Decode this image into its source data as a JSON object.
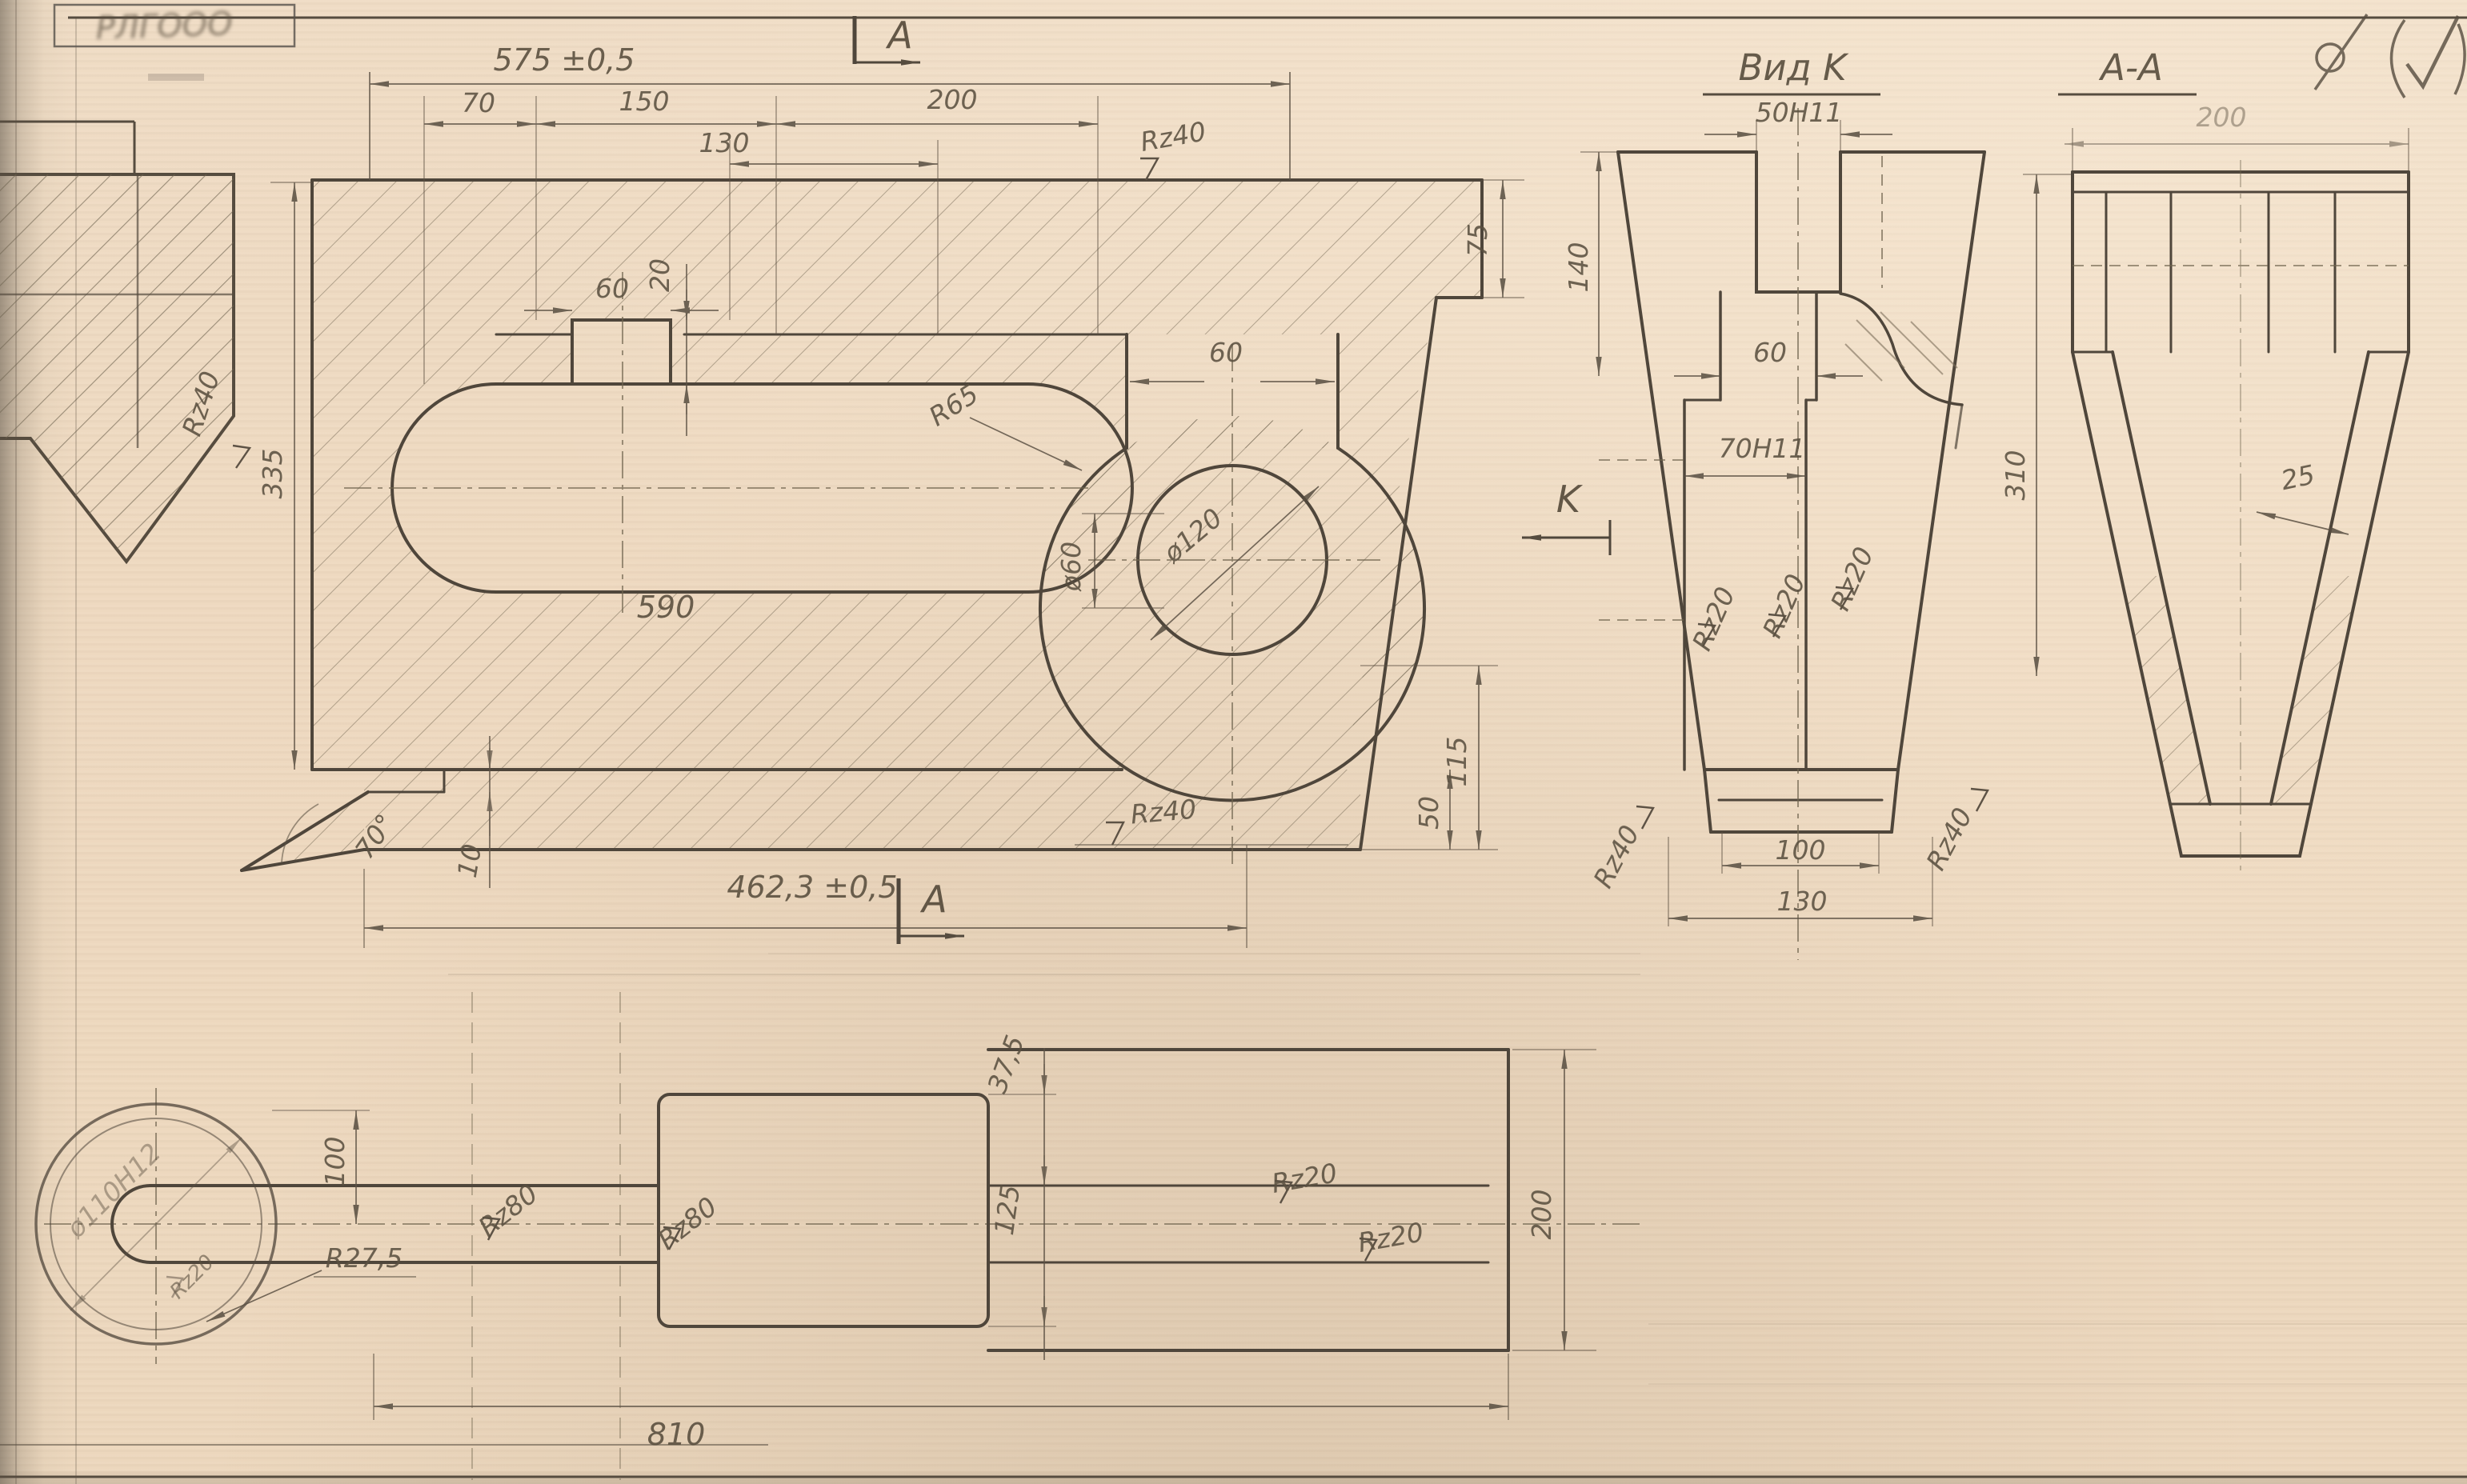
{
  "page": {
    "background": "#eed9c0",
    "ink": "#584e41"
  },
  "stamp": {
    "text": "РЛГООО"
  },
  "corner_icons": {
    "general_roughness": "circle-slash",
    "approval_check": "(✓)"
  },
  "main_view": {
    "section_label_top": "A",
    "section_label_bottom": "A",
    "view_arrow_label": "K",
    "dims": {
      "total_top": "575 ±0,5",
      "d70": "70",
      "d150": "150",
      "d200": "200",
      "d130": "130",
      "notch_w": "60",
      "notch_d": "20",
      "r65": "R65",
      "slot_len": "590",
      "neck_w": "60",
      "bore_big": "ø120",
      "bore_small": "ø60",
      "plate_t": "75",
      "h115": "115",
      "bar_t": "50",
      "step": "10",
      "angle": "70°",
      "total_bottom": "462,3 ±0,5",
      "left_h": "335"
    },
    "roughness": {
      "top": "Rz40",
      "bottom": "Rz40",
      "left": "Rz40"
    }
  },
  "view_k": {
    "title": "Вид K",
    "dims": {
      "slot": "50H11",
      "h140": "140",
      "w60": "60",
      "w70": "70H11",
      "base_inner": "100",
      "base_outer": "130"
    },
    "roughness": {
      "r1": "Rz20",
      "r2": "Rz20",
      "r3": "Rz20",
      "left": "Rz40",
      "right": "Rz40"
    }
  },
  "section_aa": {
    "title": "A-A",
    "dims": {
      "width": "200",
      "height": "310",
      "wall": "25"
    }
  },
  "bottom_view": {
    "dims": {
      "shaft": "ø110H12",
      "offset100": "100",
      "r275": "R27,5",
      "d375": "37,5",
      "d125": "125",
      "width": "200",
      "total": "810"
    },
    "roughness": {
      "circle": "Rz20",
      "handle1": "Rz80",
      "handle2": "Rz80",
      "bar1": "Rz20",
      "bar2": "Rz20"
    }
  }
}
